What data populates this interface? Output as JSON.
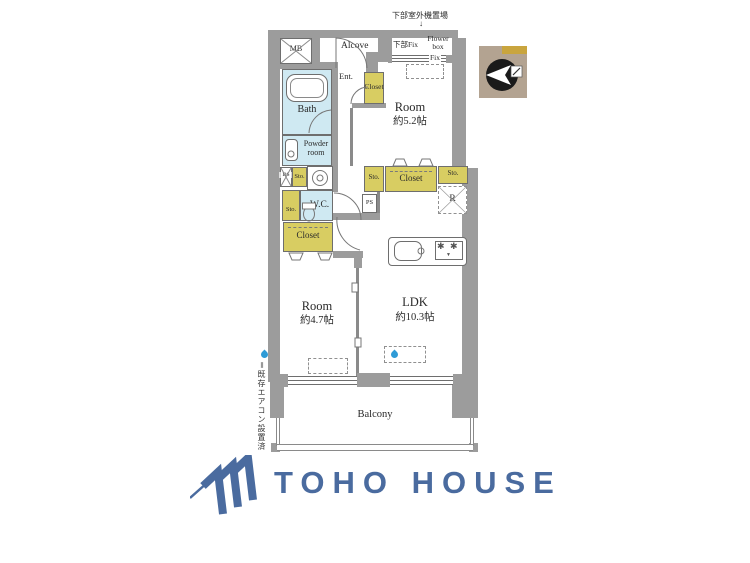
{
  "plan": {
    "notes": {
      "outdoor_unit": "下部室外機置場",
      "down_arrow": "↓",
      "side_note": "＝既存エアコン設置済"
    },
    "labels": {
      "mb": "MB",
      "alcove": "Alcove",
      "ent": "Ent.",
      "ent_closet": "Closet",
      "lower_fix": "下部Fix",
      "flower_box": "Flower box",
      "fix": "Fix",
      "room52_name": "Room",
      "room52_size": "約5.2帖",
      "bath": "Bath",
      "powder": "Powder room",
      "ds": "DS",
      "sto_laundry": "Sto.",
      "sto_wc": "Sto.",
      "wc": "W.C.",
      "closet_hall": "Closet",
      "sto_row_left": "Sto.",
      "closet_row": "Closet",
      "sto_row_right": "Sto.",
      "ps": "PS",
      "fridge": "R",
      "room47_name": "Room",
      "room47_size": "約4.7帖",
      "ldk_name": "LDK",
      "ldk_size": "約10.3帖",
      "balcony": "Balcony"
    },
    "icons": {
      "burner": "✱",
      "burner_small": "▼"
    },
    "colors": {
      "wall": "#9c9c9c",
      "water": "#cfe9f2",
      "storage": "#d8cd62",
      "line": "#6e6e6e",
      "compass_bg": "#b3a391",
      "compass_gold": "#c9a53e",
      "drop_blue": "#2e9bd6"
    }
  },
  "branding": {
    "logo_text": "TOHO HOUSE",
    "logo_color": "#4a6b9f"
  }
}
